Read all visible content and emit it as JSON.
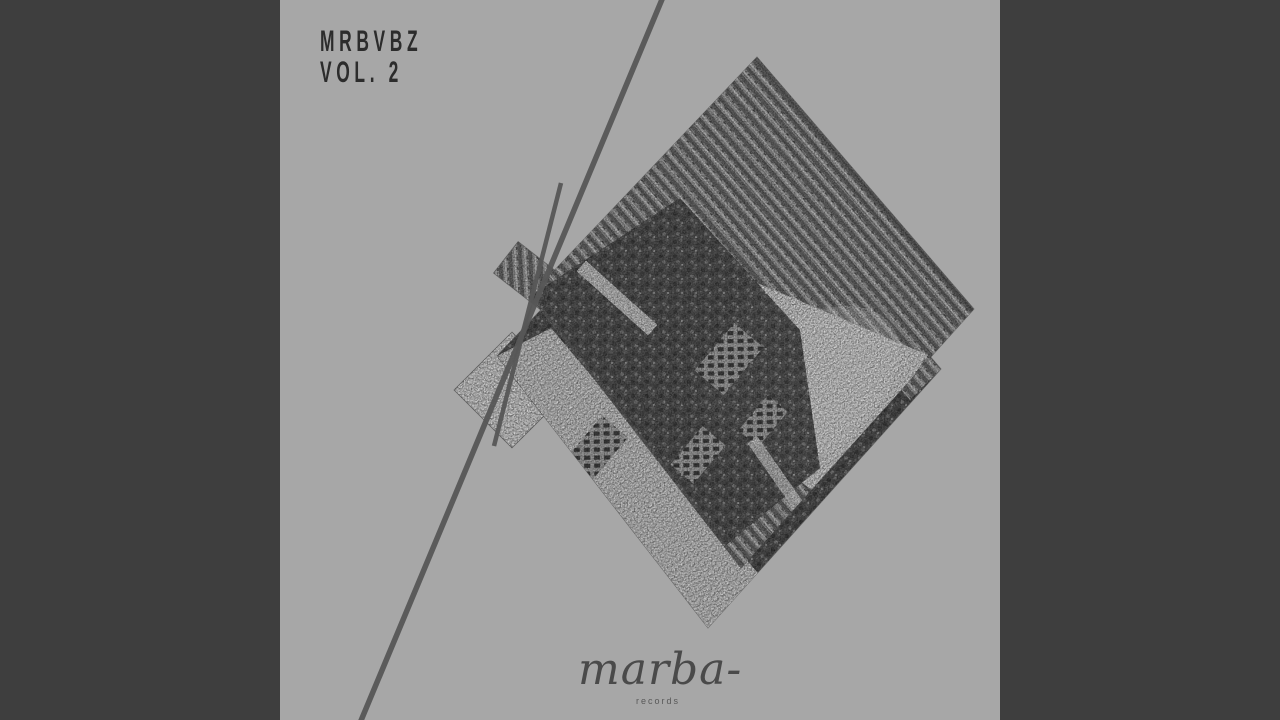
{
  "window": {
    "width_px": 1280,
    "height_px": 720
  },
  "artwork": {
    "alt": "rotated monochrome engraved cityscape collage on gray background",
    "title_line1": "MRBVBZ",
    "title_line2": "VOL. 2",
    "label": {
      "name": "marba-",
      "sub": "records"
    }
  },
  "colors": {
    "letterbox": "#3e3e3e",
    "canvas_background": "#a7a7a7",
    "diagonal_line": "#575757",
    "title_text": "#2c2c2c",
    "label_text": "#4a4a4a",
    "label_sub_text": "#585858"
  }
}
